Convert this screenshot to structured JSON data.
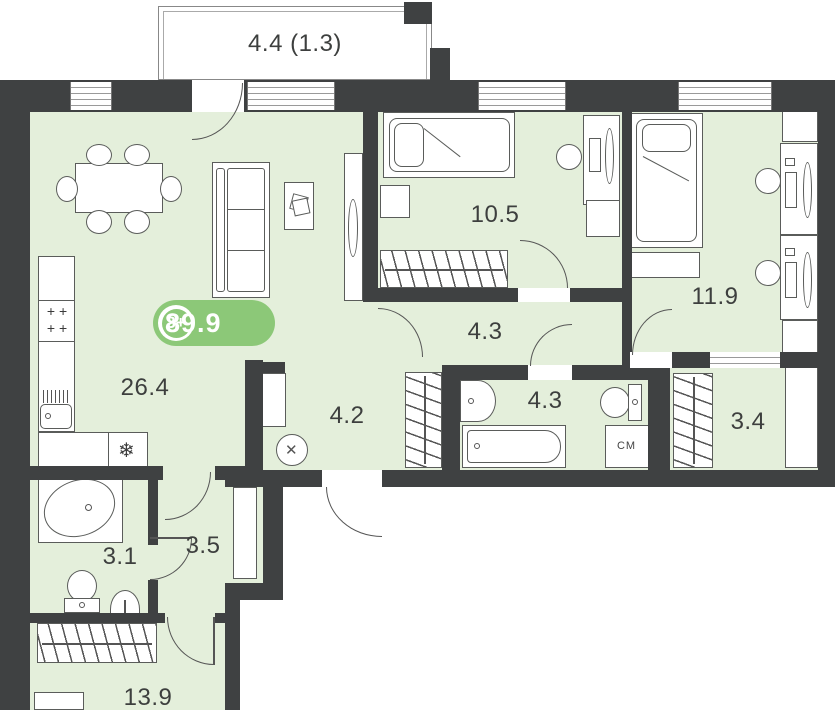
{
  "plan_type": "apartment-floor-plan",
  "badge": {
    "rooms_count": "3+",
    "total_area": "89.9"
  },
  "balcony": {
    "label": "4.4 (1.3)"
  },
  "rooms": {
    "living_kitchen": "26.4",
    "bedroom_top": "10.5",
    "bedroom_right": "11.9",
    "corridor_top": "4.3",
    "bathroom_main": "4.3",
    "corridor_entry": "4.2",
    "walkin_closet": "3.4",
    "wc_small": "3.1",
    "hall_small": "3.5",
    "bedroom_bottom": "13.9"
  },
  "appliances": {
    "washing_machine": "СМ",
    "stove_burners": "+ +\n+ +"
  },
  "symbols": {
    "fridge_snowflake": "❄",
    "vent_cross": "✕"
  },
  "colors": {
    "wall": "#3f4142",
    "room_fill": "#e4efdb",
    "badge_green": "#8cc878",
    "furniture_line": "#5a5c5a"
  }
}
